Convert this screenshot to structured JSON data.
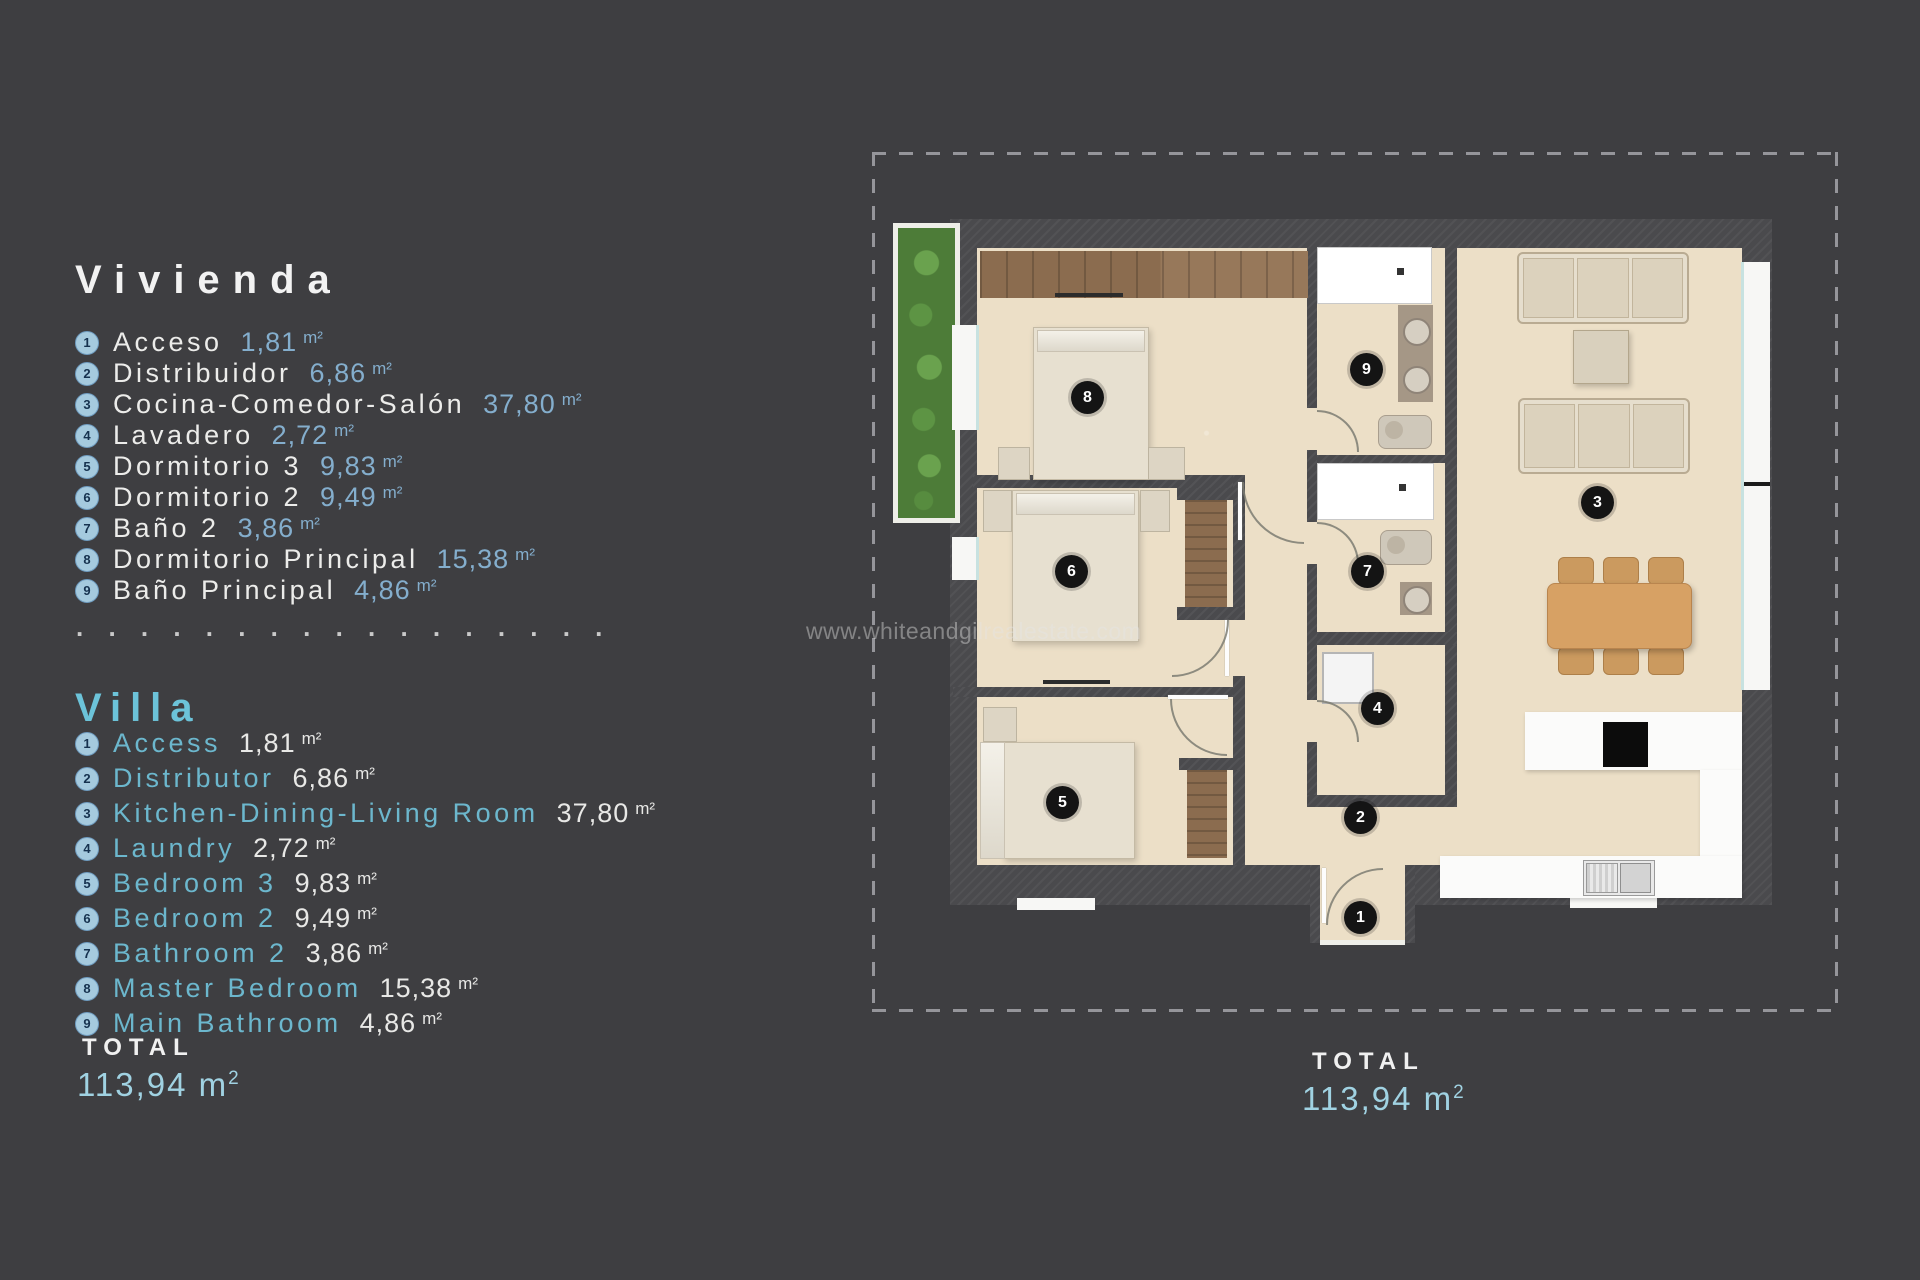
{
  "watermark": "www.whiteandgilrealestate.com",
  "separator": ". . . . . . . . . . . . . . . . .",
  "legend_es": {
    "title": "Vivienda",
    "items": [
      {
        "num": "1",
        "name": "Acceso",
        "area": "1,81",
        "unit": "m²"
      },
      {
        "num": "2",
        "name": "Distribuidor",
        "area": "6,86",
        "unit": "m²"
      },
      {
        "num": "3",
        "name": "Cocina-Comedor-Salón",
        "area": "37,80",
        "unit": "m²"
      },
      {
        "num": "4",
        "name": "Lavadero",
        "area": "2,72",
        "unit": "m²"
      },
      {
        "num": "5",
        "name": "Dormitorio 3",
        "area": "9,83",
        "unit": "m²"
      },
      {
        "num": "6",
        "name": "Dormitorio 2",
        "area": "9,49",
        "unit": "m²"
      },
      {
        "num": "7",
        "name": "Baño 2",
        "area": "3,86",
        "unit": "m²"
      },
      {
        "num": "8",
        "name": "Dormitorio Principal",
        "area": "15,38",
        "unit": "m²"
      },
      {
        "num": "9",
        "name": "Baño Principal",
        "area": "4,86",
        "unit": "m²"
      }
    ]
  },
  "legend_en": {
    "title": "Villa",
    "items": [
      {
        "num": "1",
        "name": "Access",
        "area": "1,81",
        "unit": "m²"
      },
      {
        "num": "2",
        "name": "Distributor",
        "area": "6,86",
        "unit": "m²"
      },
      {
        "num": "3",
        "name": "Kitchen-Dining-Living Room",
        "area": "37,80",
        "unit": "m²"
      },
      {
        "num": "4",
        "name": "Laundry",
        "area": "2,72",
        "unit": "m²"
      },
      {
        "num": "5",
        "name": "Bedroom 3",
        "area": "9,83",
        "unit": "m²"
      },
      {
        "num": "6",
        "name": "Bedroom 2",
        "area": "9,49",
        "unit": "m²"
      },
      {
        "num": "7",
        "name": "Bathroom 2",
        "area": "3,86",
        "unit": "m²"
      },
      {
        "num": "8",
        "name": "Master Bedroom",
        "area": "15,38",
        "unit": "m²"
      },
      {
        "num": "9",
        "name": "Main Bathroom",
        "area": "4,86",
        "unit": "m²"
      }
    ]
  },
  "totals": {
    "left": {
      "label": "TOTAL",
      "value": "113,94 m",
      "sup": "2"
    },
    "right": {
      "label": "TOTAL",
      "value": "113,94 m",
      "sup": "2"
    }
  },
  "plan": {
    "markers": [
      {
        "num": "1",
        "x": 488,
        "y": 765
      },
      {
        "num": "2",
        "x": 488,
        "y": 665
      },
      {
        "num": "3",
        "x": 725,
        "y": 350
      },
      {
        "num": "4",
        "x": 505,
        "y": 556
      },
      {
        "num": "5",
        "x": 190,
        "y": 650
      },
      {
        "num": "6",
        "x": 199,
        "y": 419
      },
      {
        "num": "7",
        "x": 495,
        "y": 419
      },
      {
        "num": "8",
        "x": 215,
        "y": 245
      },
      {
        "num": "9",
        "x": 494,
        "y": 217
      }
    ]
  },
  "colors": {
    "background": "#3e3e41",
    "wall": "#4a4a4d",
    "floor": "#ecdfc7",
    "accent_blue": "#84aecd",
    "villa_blue": "#6cc3d9",
    "marker": "#141414",
    "garden": "#4d7c38",
    "wood": "#8b6c4f",
    "dining": "#d7a164"
  }
}
